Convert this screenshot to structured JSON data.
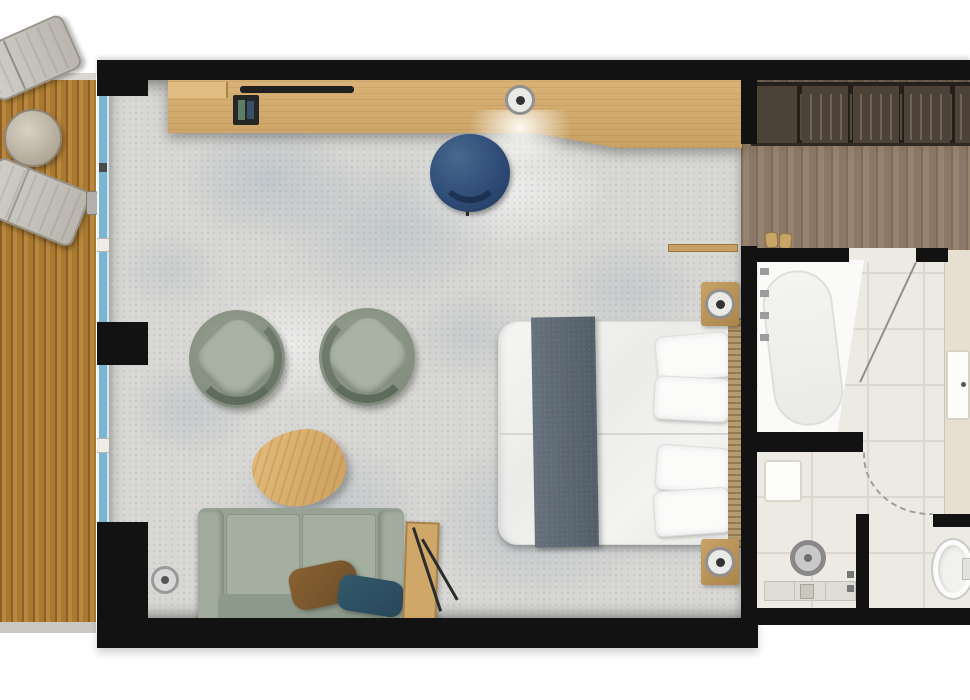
{
  "meta": {
    "type": "floor-plan",
    "view": "top-down",
    "label": "hotel-suite-floor-plan"
  },
  "palette": {
    "wall": "#121212",
    "deck_wood": "#a97930",
    "carpet": "#d8d7d3",
    "carpet_speckle": "#8aa0b6",
    "hall_wood": "#8b7866",
    "wardrobe_wood": "#4c4238",
    "bath_tile": "#edeae3",
    "window_glass": "#7cb5d1",
    "desk_wood": "#d2a96a",
    "desk_chair_blue": "#2d4a74",
    "sofa_green": "#97a295",
    "armchair_green": "#8d988a",
    "coffee_table_wood": "#d9b173",
    "bed_runner_slate": "#5b6671",
    "headboard_wood": "#b49a6e",
    "pillow_brown": "#7a5a33",
    "pillow_teal": "#2f5465",
    "fixture_white": "#fafaf9"
  },
  "rooms": {
    "terrace": {
      "label": "terrace-deck",
      "floor": "wood-deck",
      "items": [
        "sun-lounger",
        "round-side-table",
        "sun-lounger",
        "sliding-door-handle"
      ]
    },
    "living_bedroom": {
      "label": "living-bedroom",
      "floor": "speckled-carpet",
      "items": [
        "desk-console",
        "amenity-tray",
        "ceiling-light",
        "desk-chair",
        "swivel-armchair",
        "swivel-armchair",
        "coffee-table",
        "sofa",
        "throw-pillow-brown",
        "throw-pillow-teal",
        "side-table",
        "floor-lamp",
        "ceiling-speaker",
        "double-bed",
        "bed-runner",
        "bed-pillows",
        "headboard-panel",
        "nightstand-with-lamp",
        "nightstand-with-lamp",
        "threshold-trim"
      ]
    },
    "entry_hall": {
      "label": "entry-hall",
      "floor": "dark-wood",
      "items": [
        "wardrobe-with-hangers",
        "slippers"
      ]
    },
    "bathroom": {
      "label": "bathroom",
      "floor": "tile",
      "items": [
        "bathtub",
        "tub-faucet",
        "vanity-counter",
        "sink",
        "shower-shelf",
        "rain-shower-head",
        "shower-bench",
        "shower-drain",
        "shower-controls",
        "toilet",
        "door-leaf",
        "door-swing-arc"
      ]
    }
  }
}
